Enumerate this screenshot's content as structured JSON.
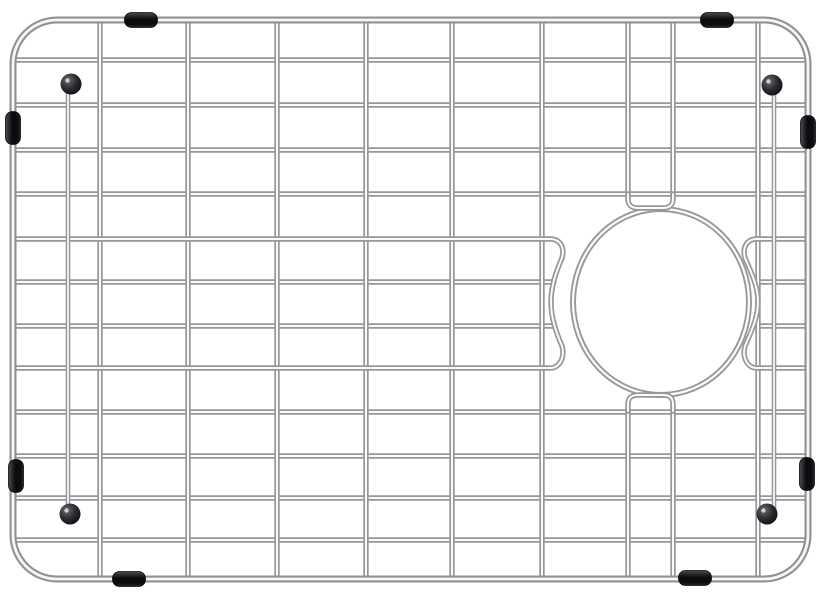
{
  "meta": {
    "alt_text": "Stainless steel wire sink bottom grid with rounded corners, a circular drain opening near the right side, black rubber feet and edge bumpers, photographed on a white background"
  },
  "canvas": {
    "width": 825,
    "height": 600,
    "background": "#ffffff"
  },
  "palette": {
    "wire_base": "#97979c",
    "wire_highlight": "#fafafa",
    "frame_base": "#909096",
    "frame_highlight": "#f7f7f8",
    "rubber_dark": "#0c0c0e",
    "rubber_mid": "#2a2a30",
    "rubber_light": "#4a4a52",
    "foot_core": "#6a6a72",
    "foot_mid": "#2b2b31",
    "foot_edge": "#0f0f12",
    "foot_specular": "#e8e8ec"
  },
  "frame": {
    "x": 13,
    "y": 20,
    "width": 795,
    "height": 559,
    "corner_radius": 44,
    "base_width": 7,
    "highlight_width": 2.8
  },
  "grid": {
    "wire_base_width": 5.4,
    "wire_highlight_width": 2,
    "x_min": 13,
    "x_max": 808,
    "y_min": 20,
    "y_max": 579,
    "horizontal_full": [
      60,
      105,
      150,
      194,
      412,
      456,
      498,
      540
    ],
    "horizontal_split": [
      {
        "y": 282,
        "segments": [
          [
            13,
            554
          ],
          [
            757,
            808
          ]
        ]
      },
      {
        "y": 326,
        "segments": [
          [
            13,
            554
          ],
          [
            757,
            808
          ]
        ]
      }
    ],
    "vertical_full": [
      100,
      188,
      277,
      366,
      452,
      542,
      758
    ],
    "vertical_split": [
      {
        "x": 628,
        "segments": [
          [
            20,
            194
          ],
          [
            411,
            579
          ]
        ]
      },
      {
        "x": 673,
        "segments": [
          [
            20,
            194
          ],
          [
            411,
            579
          ]
        ]
      }
    ]
  },
  "drain_opening": {
    "cx": 661,
    "cy": 302,
    "rx": 88,
    "ry": 93,
    "ring_base_width": 6,
    "ring_highlight_width": 2.3,
    "top_tab_path": "M 628 194 V 199 Q 628 208 638 208 H 663 Q 673 208 673 199 V 194",
    "bottom_tab_path": "M 628 411 V 404 Q 628 395 638 395 H 663 Q 673 395 673 404 V 411",
    "left_wrap_path": "M 13 239 H 550 C 560 239 565 247 562 258 C 556 272 551 286 551 302 C 551 318 556 332 562 346 C 565 357 560 368 550 368 H 13",
    "right_wrap_path": "M 808 239 H 757 C 747 239 742 247 745 258 C 751 272 758 286 758 302 C 758 318 751 332 745 346 C 742 357 747 368 757 368 H 808"
  },
  "legs": {
    "base_width": 4.6,
    "highlight_width": 1.7,
    "rails": [
      {
        "x": 68,
        "y1": 84,
        "y2": 514
      },
      {
        "x": 774,
        "y1": 85,
        "y2": 514
      }
    ]
  },
  "feet": {
    "radius": 10.5,
    "positions": [
      {
        "cx": 71,
        "cy": 84
      },
      {
        "cx": 70,
        "cy": 514
      },
      {
        "cx": 772,
        "cy": 85
      },
      {
        "cx": 767,
        "cy": 514
      }
    ]
  },
  "bumpers": {
    "length": 33,
    "thickness": 15,
    "corner_radius": 7,
    "items": [
      {
        "edge": "top",
        "cx": 141,
        "cy": 20
      },
      {
        "edge": "top",
        "cx": 717,
        "cy": 20
      },
      {
        "edge": "bottom",
        "cx": 129,
        "cy": 579
      },
      {
        "edge": "bottom",
        "cx": 695,
        "cy": 578
      },
      {
        "edge": "left",
        "cx": 13,
        "cy": 128
      },
      {
        "edge": "left",
        "cx": 16,
        "cy": 476
      },
      {
        "edge": "right",
        "cx": 808,
        "cy": 132
      },
      {
        "edge": "right",
        "cx": 807,
        "cy": 474
      }
    ]
  }
}
